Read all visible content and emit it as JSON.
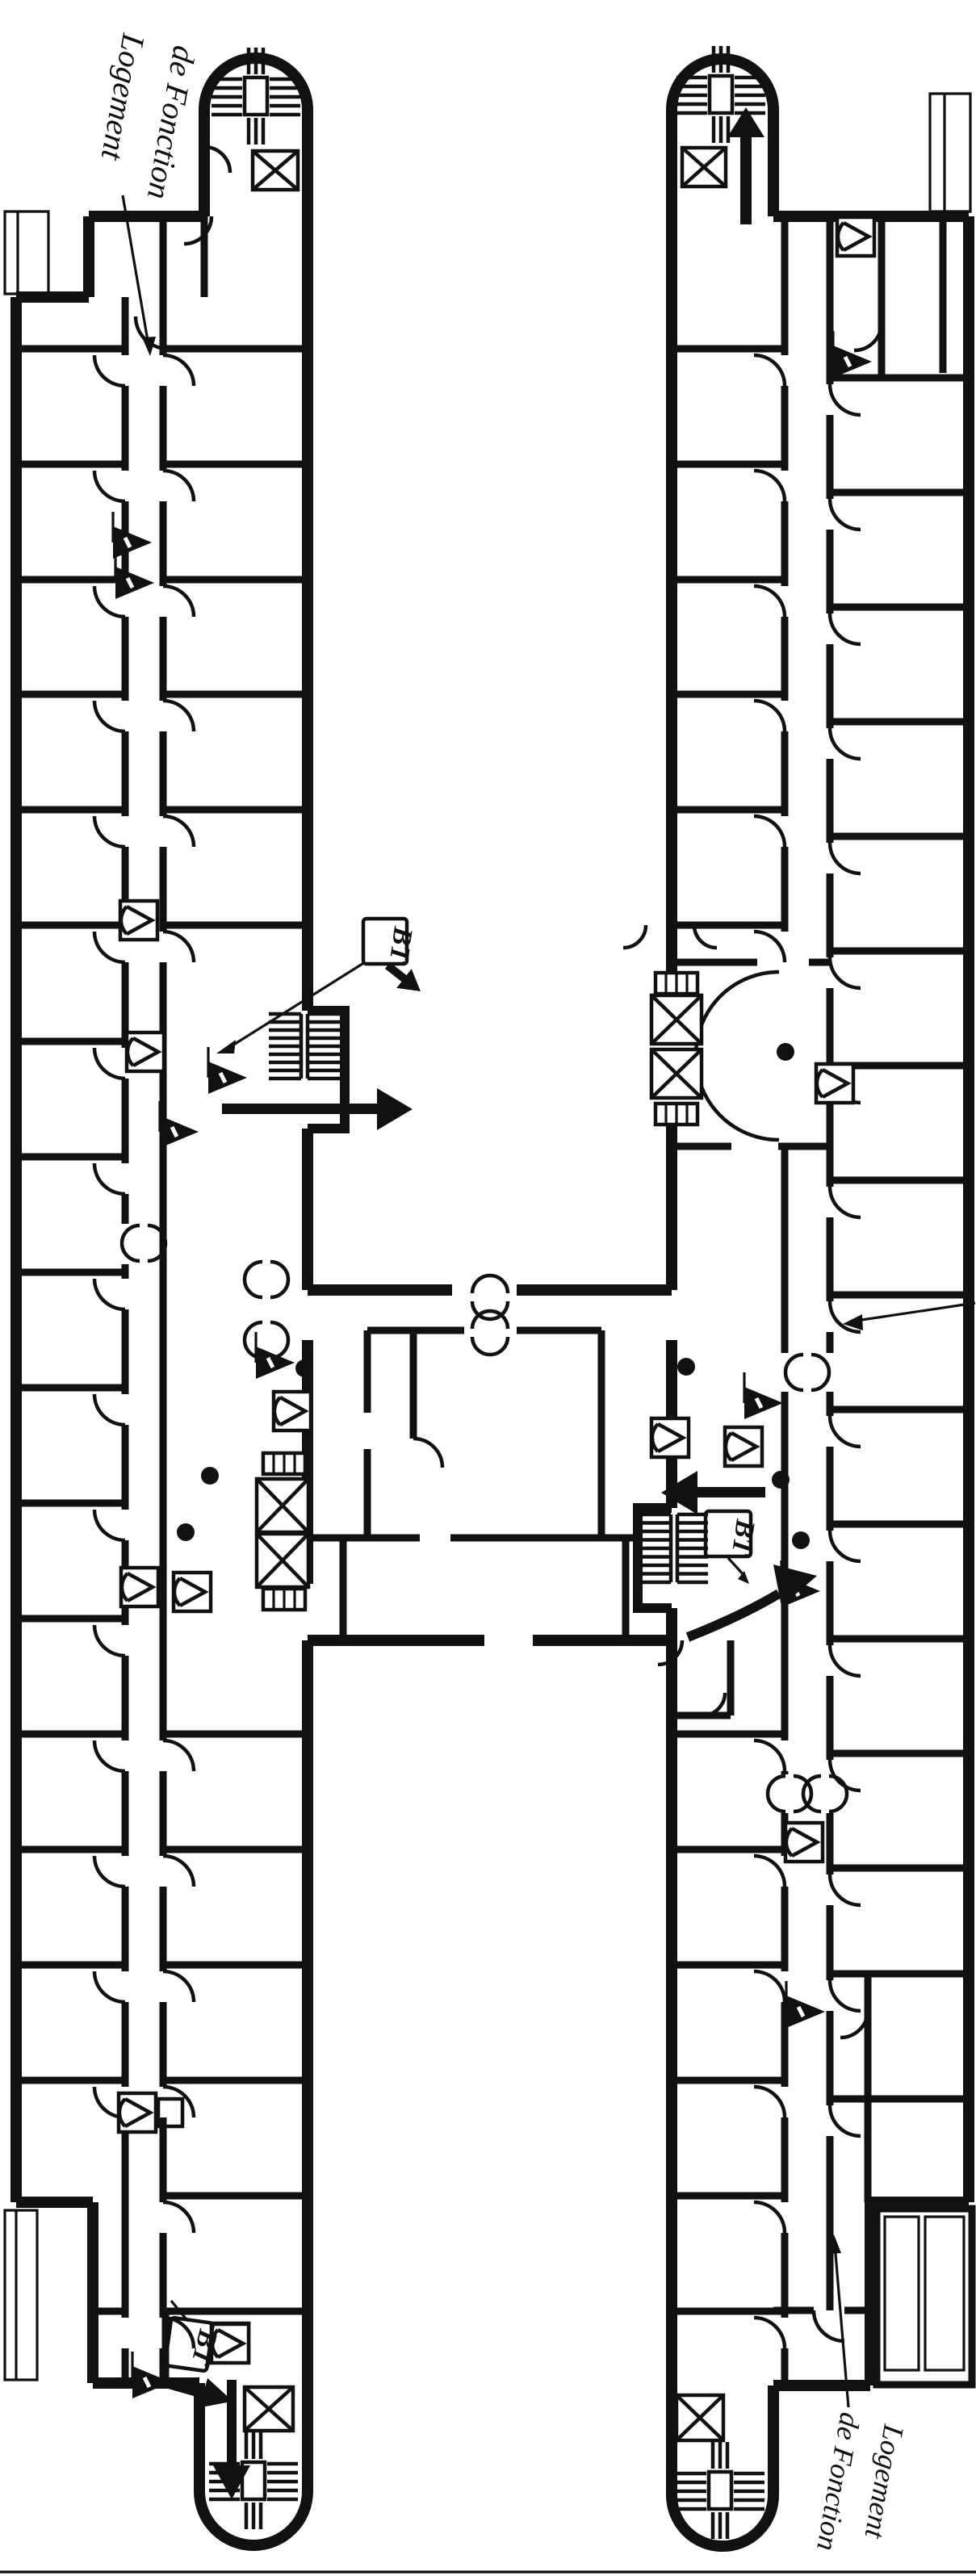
{
  "figure": {
    "kind": "architectural floor plan",
    "building_shape": "H-plan, two long wings linked by a central bar",
    "colors": {
      "ink": "#111111",
      "paper": "#ffffff"
    }
  },
  "annotations": {
    "logement_top": {
      "line1": "Logement",
      "line2": "de Fonction"
    },
    "logement_bottom": {
      "line1": "Logement",
      "line2": "de Fonction"
    },
    "bt_boxes": [
      {
        "text": "BT"
      },
      {
        "text": "BT"
      },
      {
        "text": "BT"
      }
    ]
  },
  "icons": {
    "stairs": "stair-tread-hatch-icon",
    "elevator": "crossed-box-elevator-icon",
    "fire_hose_reel": "square-cone-hose-reel-icon",
    "fire_extinguisher": "filled-triangle-flag-icon",
    "column": "filled-dot-column-icon",
    "door": "quarter-arc-door-swing-icon",
    "double_door": "facing-half-disc-double-door-icon",
    "exit_arrow": "bold-exit-arrow-icon",
    "leader_arrow": "thin-leader-arrow-icon"
  }
}
